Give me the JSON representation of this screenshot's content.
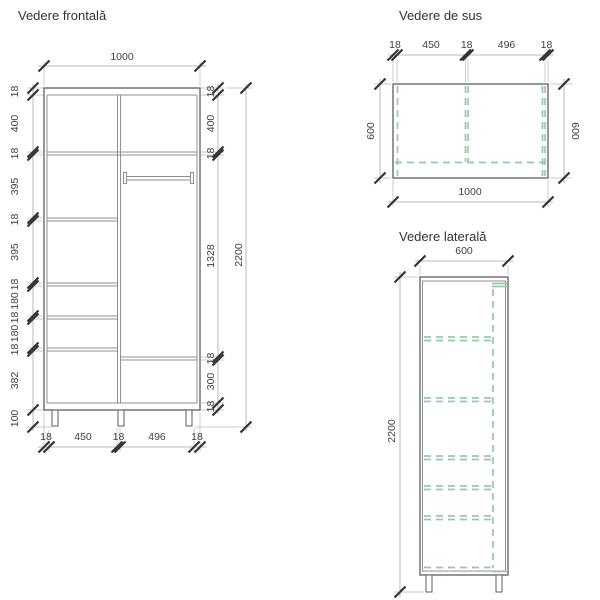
{
  "colors": {
    "outline": "#6a6a6a",
    "inner_line": "#8f8f8f",
    "dimension_line": "#b8b8b8",
    "tick": "#333333",
    "text": "#3f3f3f",
    "dashed_green": "#96c9a5",
    "background": "#ffffff"
  },
  "views": {
    "front": {
      "title": "Vedere frontală",
      "width_dim": "1000",
      "left_chain": [
        "18",
        "400",
        "18",
        "395",
        "18",
        "395",
        "18",
        "180",
        "18",
        "180",
        "18",
        "382",
        "100"
      ],
      "right_chain": [
        "18",
        "400",
        "18",
        "1328",
        "18",
        "300",
        "18"
      ],
      "overall_height": "2200",
      "bottom_chain": [
        "18",
        "450",
        "18",
        "496",
        "18"
      ]
    },
    "top": {
      "title": "Vedere de sus",
      "top_chain": [
        "18",
        "450",
        "18",
        "496",
        "18"
      ],
      "depth_left": "600",
      "depth_right": "600",
      "width_dim": "1000"
    },
    "side": {
      "title": "Vedere laterală",
      "depth_dim": "600",
      "height_dim": "2200"
    }
  }
}
